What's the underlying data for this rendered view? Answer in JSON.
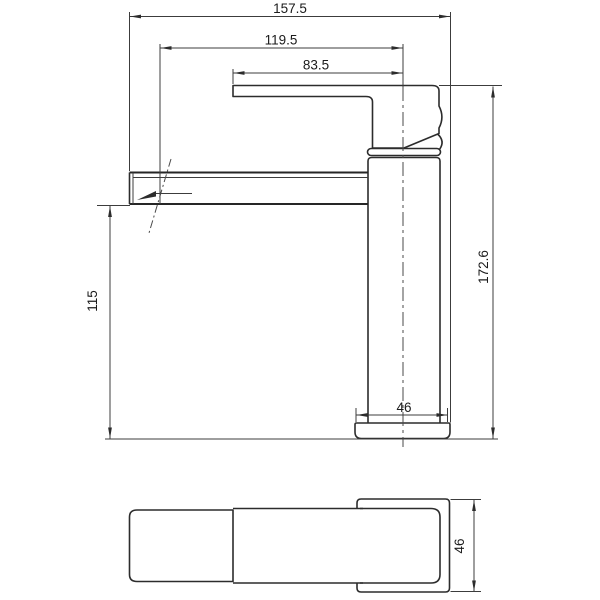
{
  "drawing": {
    "kind": "technical-dimension-drawing",
    "colors": {
      "background": "#ffffff",
      "object_line": "#2c2c2c",
      "dimension_line": "#3c3c3c",
      "text": "#1b1b1b"
    },
    "side_view": {
      "dim_overall_length": "157.5",
      "dim_aerator_reach": "119.5",
      "dim_handle_reach": "83.5",
      "dim_overall_height": "172.6",
      "dim_spout_height": "115",
      "dim_base_width": "46"
    },
    "plan_view": {
      "dim_base_width": "46"
    }
  }
}
